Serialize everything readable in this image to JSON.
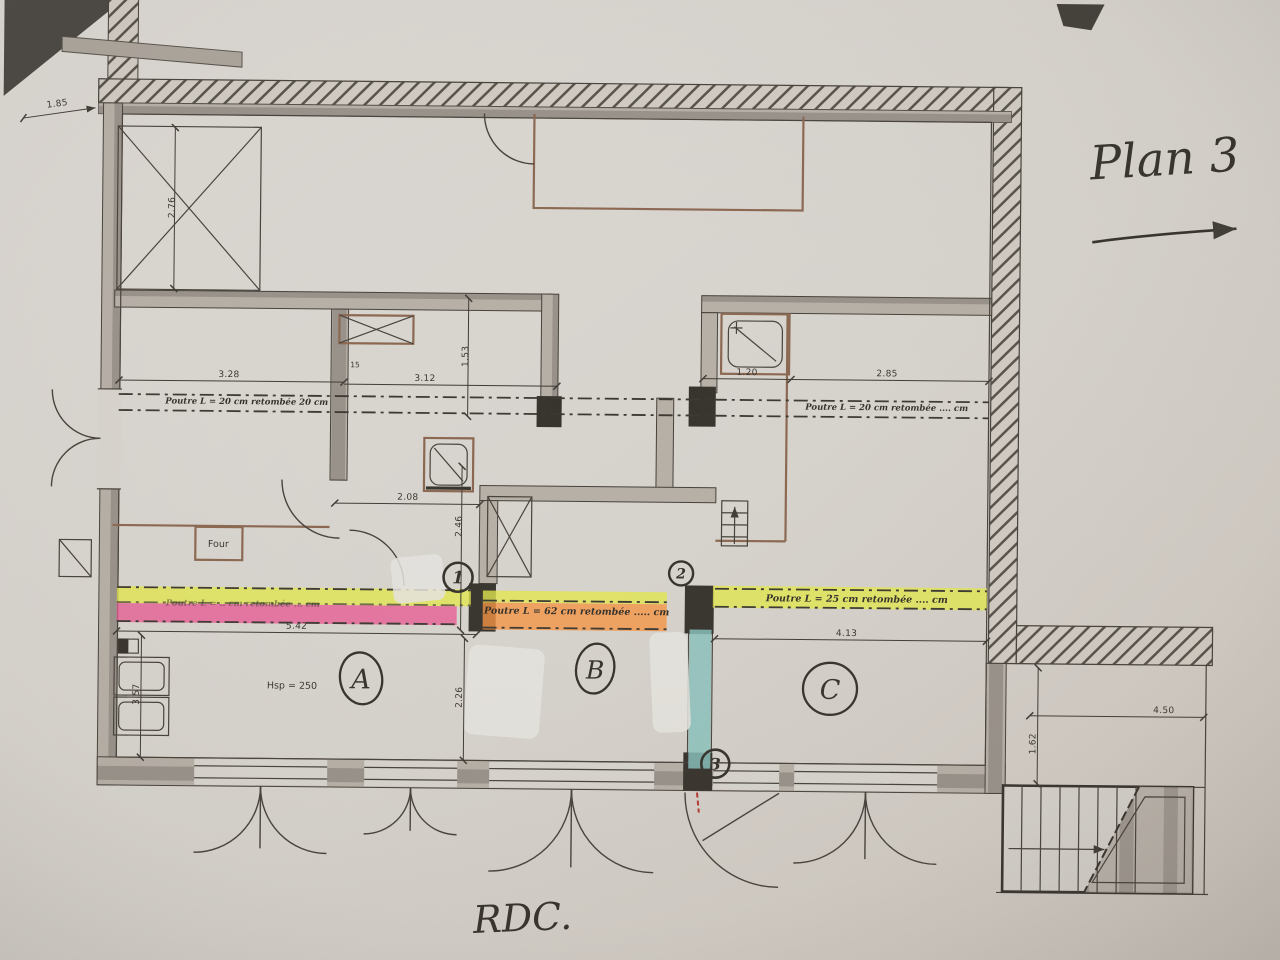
{
  "document": {
    "plan_title": "Plan 3",
    "floor_label": "RDC.",
    "room_height_note": "Hsp = 250",
    "oven_label": "Four"
  },
  "zones": {
    "a": "A",
    "b": "B",
    "c": "C"
  },
  "markers": {
    "m1": "1",
    "m2": "2",
    "m3": "3"
  },
  "beam_notes": {
    "left_upper": "Poutre L = 20 cm retombée 20 cm",
    "right_upper": "Poutre L = 20 cm retombée .... cm",
    "center_lower": "Poutre L = 62 cm retombée ..... cm",
    "right_lower": "Poutre L = 25 cm retombée .... cm",
    "left_lower": "Poutre L = .. cm retombée ... cm"
  },
  "dimensions": {
    "d185": "1.85",
    "d276": "2.76",
    "d328": "3.28",
    "d312": "3.12",
    "d153": "1.53",
    "d15": "15",
    "d120": "1.20",
    "d285": "2.85",
    "d208": "2.08",
    "d246": "2.46",
    "d542": "5.42",
    "d357": "3.57",
    "d226": "2.26",
    "d413": "4.13",
    "d450": "4.50",
    "d162": "1.62"
  },
  "highlight_colors": {
    "yellow": "#e3e84c",
    "pink": "#e85b94",
    "orange": "#f79441",
    "teal": "#8ecbc6"
  }
}
